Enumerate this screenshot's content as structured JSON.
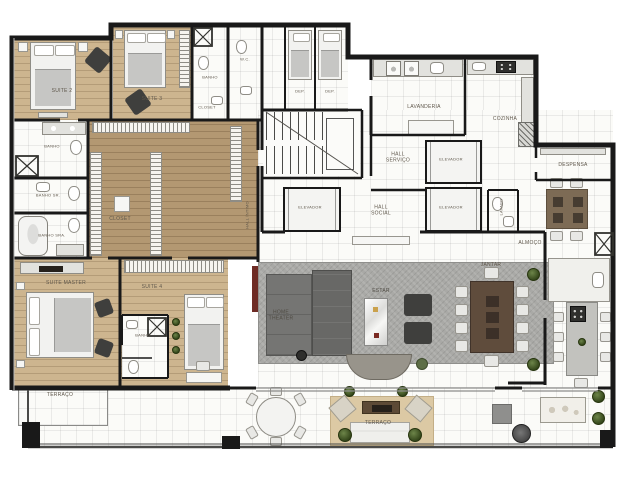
{
  "title": "Planta de apartamento - pavimento tipo",
  "colors": {
    "wall": "#191919",
    "wood_light": "#cdb58f",
    "wood_dark": "#b39872",
    "tile": "#fbfbf8",
    "rug": "#a9a9a6",
    "table_brown": "#5f4c3c",
    "tv_panel_red": "#6e2b24",
    "plant_green": "#3c5122"
  },
  "rooms": {
    "suite2": {
      "label": "SUITE 2"
    },
    "suite3": {
      "label": "SUITE 3"
    },
    "closet_suite3": {
      "label": "CLOSET"
    },
    "banho_suite3": {
      "label": "BANHO"
    },
    "wc": {
      "label": "W.C."
    },
    "dep1": {
      "label": "DEP."
    },
    "dep2": {
      "label": "DEP."
    },
    "lavanderia": {
      "label": "LAVANDERIA"
    },
    "cozinha": {
      "label": "COZINHA"
    },
    "hall_servico": {
      "label": "HALL SERVIÇO"
    },
    "elevador_servico": {
      "label": "ELEVADOR"
    },
    "elevador_social_1": {
      "label": "ELEVADOR"
    },
    "hall_social": {
      "label": "HALL SOCIAL"
    },
    "elevador_social_2": {
      "label": "ELEVADOR"
    },
    "despensa": {
      "label": "DESPENSA"
    },
    "lavabo": {
      "label": "LAVABO"
    },
    "almoco": {
      "label": "ALMOÇO"
    },
    "banho_suite2": {
      "label": "BANHO"
    },
    "banho_sr": {
      "label": "BANHO SR."
    },
    "banho_sra": {
      "label": "BANHO SRA."
    },
    "closet_master": {
      "label": "CLOSET"
    },
    "hall_intimo": {
      "label": "HALL ÍNTIMO"
    },
    "suite_master": {
      "label": "SUITE MASTER"
    },
    "suite4": {
      "label": "SUITE 4"
    },
    "banho_suite4": {
      "label": "BANHO"
    },
    "terraco_left": {
      "label": "TERRAÇO"
    },
    "home_theater": {
      "label": "HOME THEATER"
    },
    "estar": {
      "label": "ESTAR"
    },
    "jantar": {
      "label": "JANTAR"
    },
    "terraco_main": {
      "label": "TERRAÇO"
    }
  }
}
